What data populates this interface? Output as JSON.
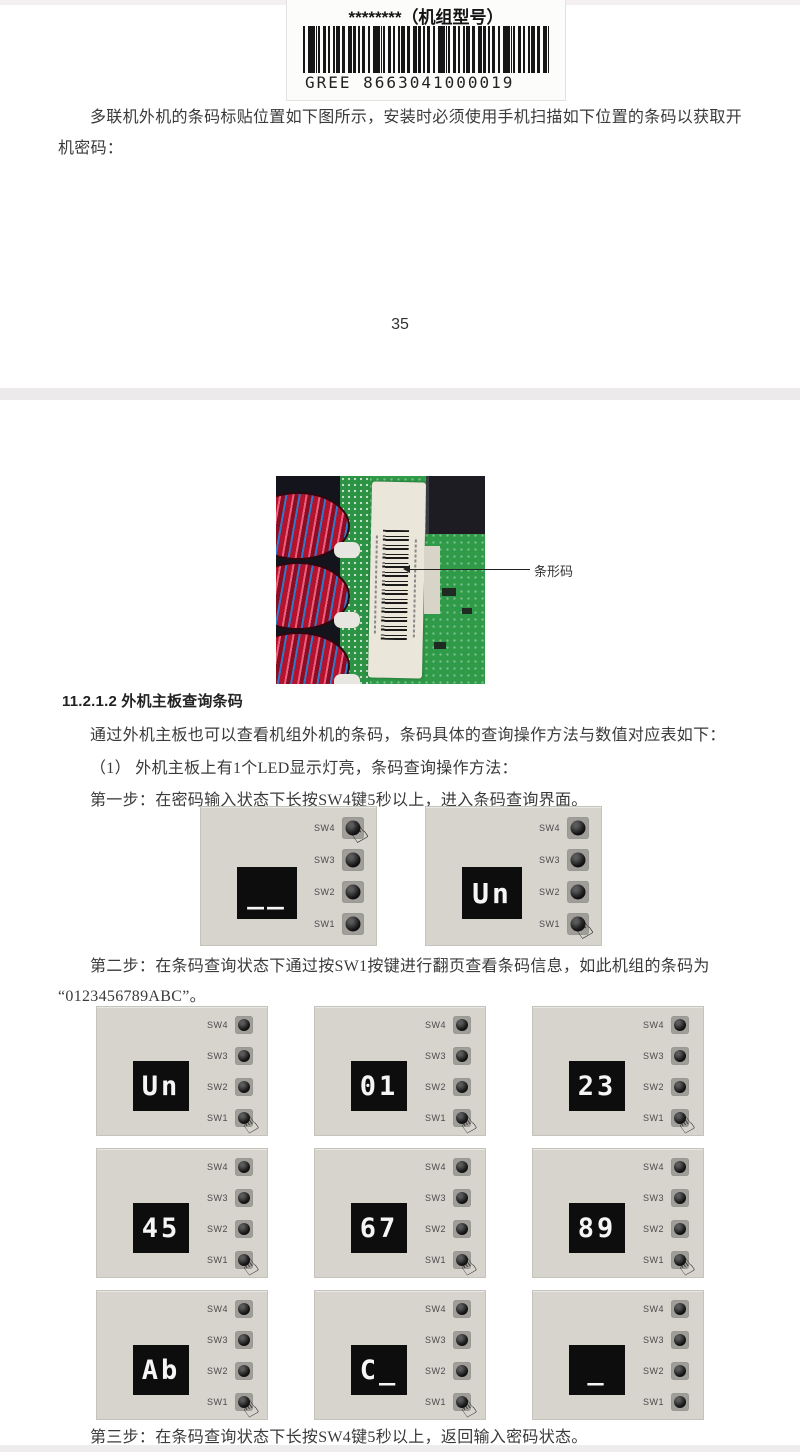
{
  "document": {
    "page_top": {
      "barcode_label": {
        "title": "********（机组型号）",
        "code_text": "GREE 8663041000019"
      },
      "intro_text": "多联机外机的条码标贴位置如下图所示，安装时必须使用手机扫描如下位置的条码以获取开机密码：",
      "page_number": "35"
    },
    "page_bottom": {
      "photo": {
        "callout_label": "条形码"
      },
      "section_heading": "11.2.1.2 外机主板查询条码",
      "paragraphs": {
        "query_intro": "通过外机主板也可以查看机组外机的条码，条码具体的查询操作方法与数值对应表如下：",
        "led_note": "（1） 外机主板上有1个LED显示灯亮，条码查询操作方法：",
        "step1": "第一步：在密码输入状态下长按SW4键5秒以上，进入条码查询界面。",
        "step2_line1": "第二步：在条码查询状态下通过按SW1按键进行翻页查看条码信息，如此机组的条码为",
        "step2_line2": "“0123456789ABC”。",
        "step3": "第三步：在条码查询状态下长按SW4键5秒以上，返回输入密码状态。"
      },
      "panels": {
        "button_labels": [
          "SW4",
          "SW3",
          "SW2",
          "SW1"
        ],
        "step1_row": [
          {
            "display": "__",
            "pressed": "SW4"
          },
          {
            "display": "Un",
            "pressed": "SW1"
          }
        ],
        "grid": [
          {
            "display": "Un",
            "pressed": "SW1"
          },
          {
            "display": "01",
            "pressed": "SW1"
          },
          {
            "display": "23",
            "pressed": "SW1"
          },
          {
            "display": "45",
            "pressed": "SW1"
          },
          {
            "display": "67",
            "pressed": "SW1"
          },
          {
            "display": "89",
            "pressed": "SW1"
          },
          {
            "display": "Ab",
            "pressed": "SW1"
          },
          {
            "display": "C_",
            "pressed": "SW1"
          },
          {
            "display": "_",
            "pressed": null
          }
        ]
      }
    }
  },
  "icons": {
    "hand": "☝"
  },
  "colors": {
    "panel_bg": "#d7d4ce",
    "display_bg": "#0d0d0d",
    "digit": "#f5f5f5",
    "button_bezel": "#a09e99",
    "pcb_green": "#2f9b48",
    "coil_red": "#b5122e",
    "coil_blue": "#2f79c8",
    "sticker": "#eae6da"
  }
}
